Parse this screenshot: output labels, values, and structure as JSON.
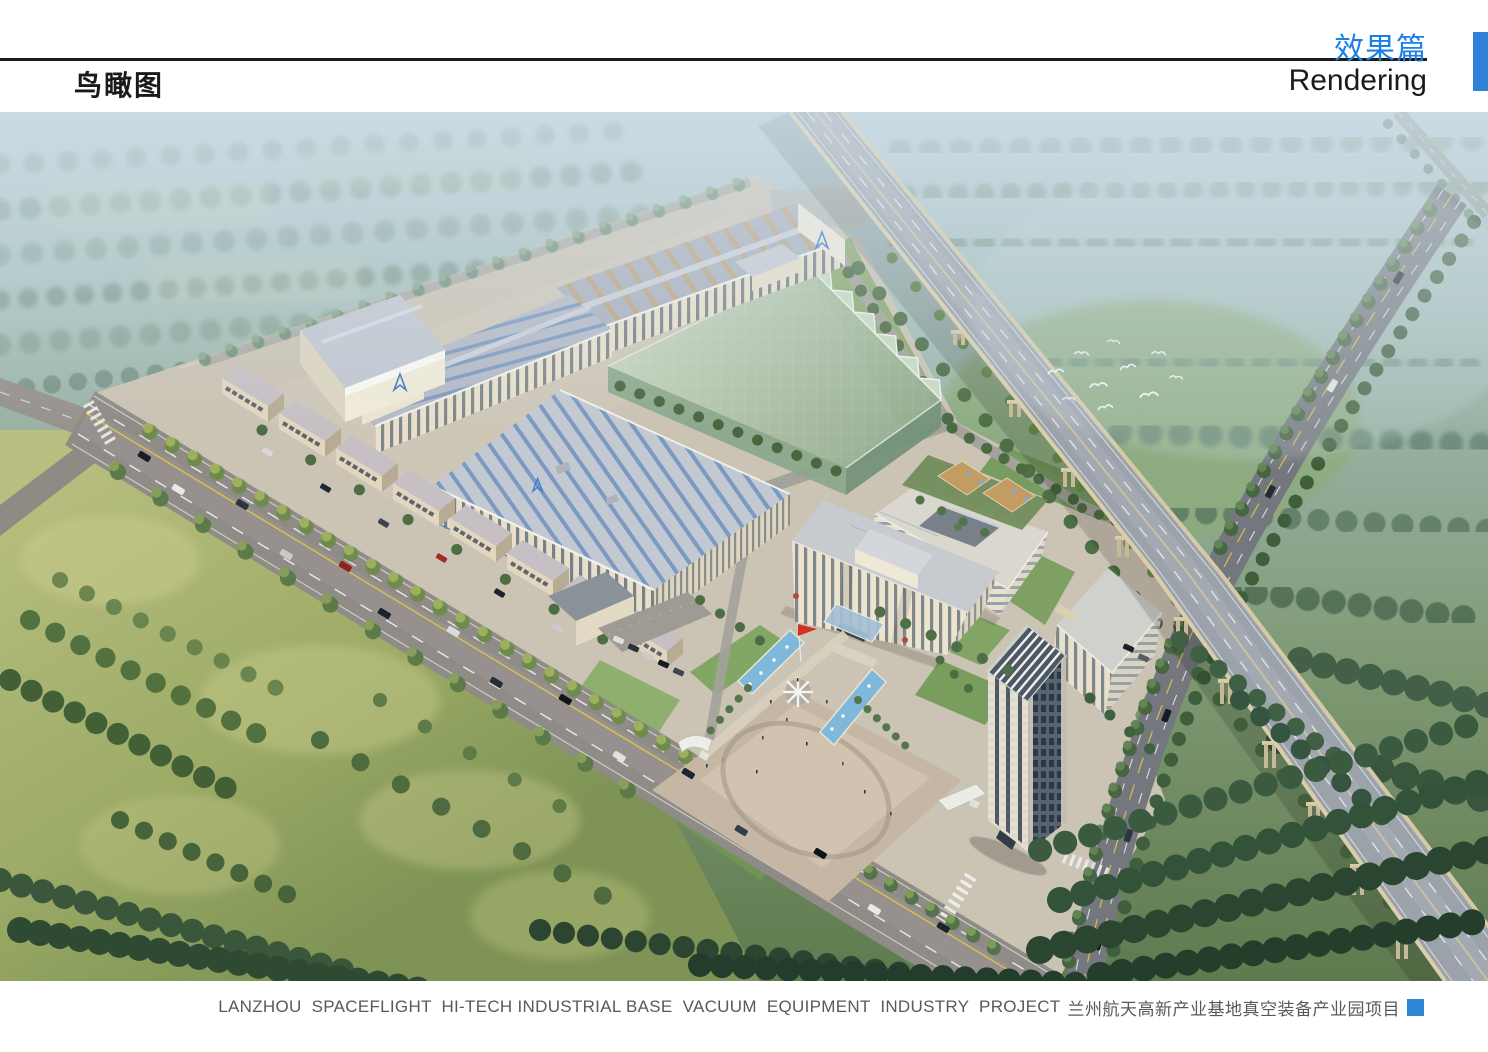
{
  "header": {
    "page_title": "鸟瞰图",
    "section_title_zh": "效果篇",
    "section_title_en": "Rendering"
  },
  "footer": {
    "caption_en": "LANZHOU  SPACEFLIGHT  HI-TECH INDUSTRIAL BASE  VACUUM  EQUIPMENT  INDUSTRY  PROJECT",
    "caption_zh": "兰州航天高新产业基地真空装备产业园项目"
  },
  "colors": {
    "accent_blue": "#1a7fe8",
    "corner_tab_blue": "#2e82d8",
    "footer_square_blue": "#2f86d4",
    "header_rule": "#1c1c1c",
    "caption_text": "#57595c",
    "glass_roof_green": "#b3c2a4",
    "workshop_stripe_blue": "#7796c0",
    "pool_blue": "#7fb8da",
    "flag_red": "#d03026"
  }
}
